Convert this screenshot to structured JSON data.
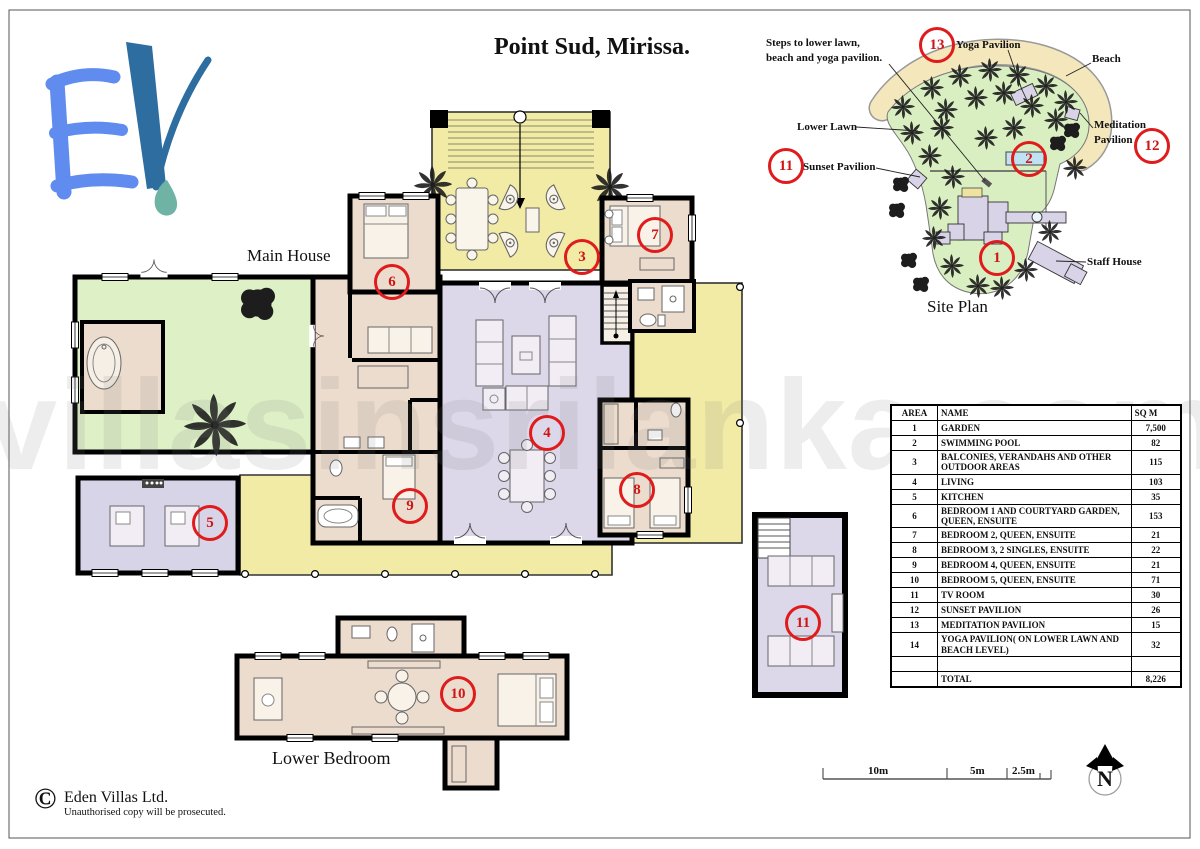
{
  "page": {
    "title": "Point Sud, Mirissa.",
    "watermark": "villasinsrilanka.com"
  },
  "labels": {
    "main_house": "Main House",
    "lower_bedroom": "Lower Bedroom",
    "site_plan": "Site Plan"
  },
  "site_plan": {
    "annotations": {
      "steps_line1": "Steps to lower lawn,",
      "steps_line2": "beach and yoga pavilion.",
      "yoga_pavilion": "Yoga Pavilion",
      "beach": "Beach",
      "lower_lawn": "Lower Lawn",
      "meditation_line1": "Meditation",
      "meditation_line2": "Pavilion",
      "sunset_pavilion": "Sunset Pavilion",
      "staff_house": "Staff House"
    },
    "markers": [
      {
        "number": "13",
        "x": 937,
        "y": 45
      },
      {
        "number": "12",
        "x": 1152,
        "y": 146
      },
      {
        "number": "11",
        "x": 786,
        "y": 166
      },
      {
        "number": "2",
        "x": 1029,
        "y": 159
      },
      {
        "number": "1",
        "x": 997,
        "y": 258
      }
    ]
  },
  "floor_plan": {
    "markers": [
      {
        "number": "3",
        "x": 582,
        "y": 257
      },
      {
        "number": "4",
        "x": 547,
        "y": 433
      },
      {
        "number": "5",
        "x": 210,
        "y": 523
      },
      {
        "number": "6",
        "x": 392,
        "y": 282
      },
      {
        "number": "7",
        "x": 655,
        "y": 235
      },
      {
        "number": "8",
        "x": 637,
        "y": 490
      },
      {
        "number": "9",
        "x": 410,
        "y": 506
      },
      {
        "number": "10",
        "x": 458,
        "y": 694
      },
      {
        "number": "11",
        "x": 803,
        "y": 623
      }
    ]
  },
  "area_table": {
    "headers": [
      "AREA",
      "NAME",
      "SQ M"
    ],
    "rows": [
      [
        "1",
        "GARDEN",
        "7,500"
      ],
      [
        "2",
        "SWIMMING POOL",
        "82"
      ],
      [
        "3",
        "BALCONIES, VERANDAHS AND OTHER OUTDOOR AREAS",
        "115"
      ],
      [
        "4",
        "LIVING",
        "103"
      ],
      [
        "5",
        "KITCHEN",
        "35"
      ],
      [
        "6",
        "BEDROOM 1 AND COURTYARD GARDEN, QUEEN, ENSUITE",
        "153"
      ],
      [
        "7",
        "BEDROOM 2, QUEEN, ENSUITE",
        "21"
      ],
      [
        "8",
        "BEDROOM 3, 2 SINGLES, ENSUITE",
        "22"
      ],
      [
        "9",
        "BEDROOM 4, QUEEN, ENSUITE",
        "21"
      ],
      [
        "10",
        "BEDROOM 5, QUEEN, ENSUITE",
        "71"
      ],
      [
        "11",
        "TV ROOM",
        "30"
      ],
      [
        "12",
        "SUNSET PAVILION",
        "26"
      ],
      [
        "13",
        "MEDITATION PAVILION",
        "15"
      ],
      [
        "14",
        "YOGA PAVILION( ON LOWER LAWN AND BEACH LEVEL)",
        "32"
      ],
      [
        "",
        "",
        ""
      ]
    ],
    "total_label": "TOTAL",
    "total_value": "8,226"
  },
  "scale_bar": {
    "labels": [
      "10m",
      "5m",
      "2.5m"
    ]
  },
  "compass": {
    "letter": "N"
  },
  "copyright": {
    "symbol": "©",
    "company": "Eden Villas Ltd.",
    "notice": "Unauthorised copy will be prosecuted."
  },
  "colors": {
    "marker_red": "#e01b1b",
    "deck_yellow": "#f1eba6",
    "living_lavender": "#dcd7e9",
    "garden_green": "#def0c6",
    "bedroom_beige": "#ecdccd",
    "pool_blue": "#bfe2f2",
    "beach_sand": "#f3e7bb",
    "logo_light_blue": "#5f8cee",
    "logo_dark_blue": "#2e6da0",
    "logo_teal": "#6fb3a4"
  }
}
